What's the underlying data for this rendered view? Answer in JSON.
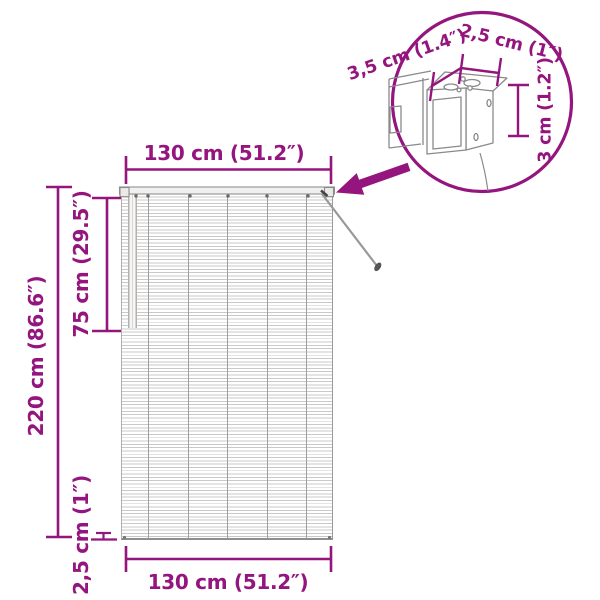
{
  "colors": {
    "accent": "#95157E"
  },
  "main_diagram": {
    "dim_width_top": "130 cm (51.2″)",
    "dim_height_partial": "75 cm (29.5″)",
    "dim_height_total": "220 cm (86.6″)",
    "dim_bottom_rail": "2,5 cm (1″)",
    "dim_width_bottom": "130 cm (51.2″)"
  },
  "detail_callout": {
    "dim_depth": "3,5 cm (1.4″)",
    "dim_width": "2,5 cm (1″)",
    "dim_height": "3 cm (1.2″)"
  }
}
